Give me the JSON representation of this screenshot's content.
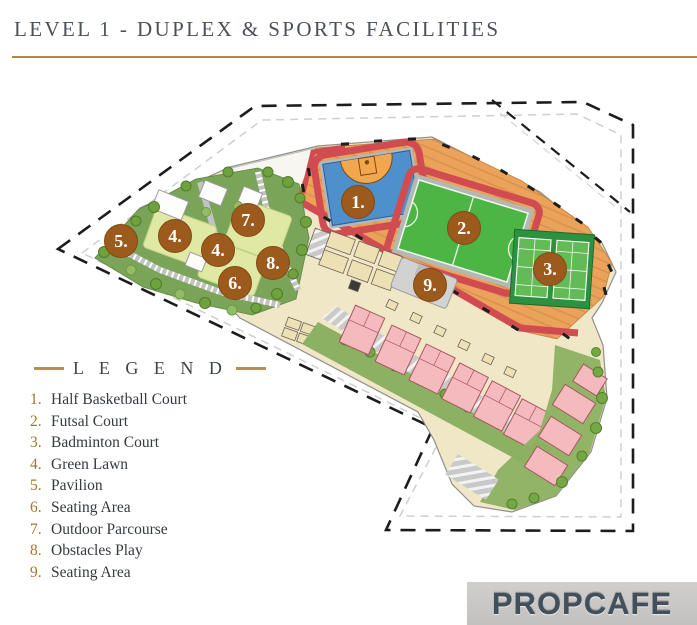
{
  "header": {
    "title": "LEVEL 1 - DUPLEX & SPORTS FACILITIES"
  },
  "legend": {
    "heading": "L E G E N D",
    "items": [
      {
        "num": "1.",
        "label": "Half Basketball Court"
      },
      {
        "num": "2.",
        "label": "Futsal Court"
      },
      {
        "num": "3.",
        "label": "Badminton Court"
      },
      {
        "num": "4.",
        "label": "Green Lawn"
      },
      {
        "num": "5.",
        "label": "Pavilion"
      },
      {
        "num": "6.",
        "label": "Seating Area"
      },
      {
        "num": "7.",
        "label": "Outdoor Parcourse"
      },
      {
        "num": "8.",
        "label": "Obstacles Play"
      },
      {
        "num": "9.",
        "label": "Seating Area"
      }
    ]
  },
  "plan": {
    "marker_color": "#9c5a1d",
    "marker_rim": "#824a14",
    "markers": [
      {
        "label": "1.",
        "x": 358,
        "y": 202
      },
      {
        "label": "2.",
        "x": 464,
        "y": 228
      },
      {
        "label": "3.",
        "x": 550,
        "y": 269
      },
      {
        "label": "5.",
        "x": 121,
        "y": 241
      },
      {
        "label": "4.",
        "x": 175,
        "y": 236
      },
      {
        "label": "7.",
        "x": 248,
        "y": 220
      },
      {
        "label": "4.",
        "x": 218,
        "y": 250
      },
      {
        "label": "6.",
        "x": 235,
        "y": 283
      },
      {
        "label": "8.",
        "x": 273,
        "y": 263
      },
      {
        "label": "9.",
        "x": 430,
        "y": 285
      }
    ],
    "colors": {
      "accent_gold": "#ab8b41",
      "track_red": "#d14c50",
      "basketball_blue": "#4d90cc",
      "key_orange": "#f2a64d",
      "futsal_green": "#4db544",
      "badminton_green": "#2c9140",
      "badminton_light": "#62bb56",
      "deck_orange": "#eba25b",
      "lawn_light": "#dfe9a4",
      "lawn_olive": "#7aa457",
      "duplex_pink": "#f5babe",
      "cream": "#f0e7c6"
    }
  },
  "watermark": {
    "text": "PROPCAFE"
  }
}
